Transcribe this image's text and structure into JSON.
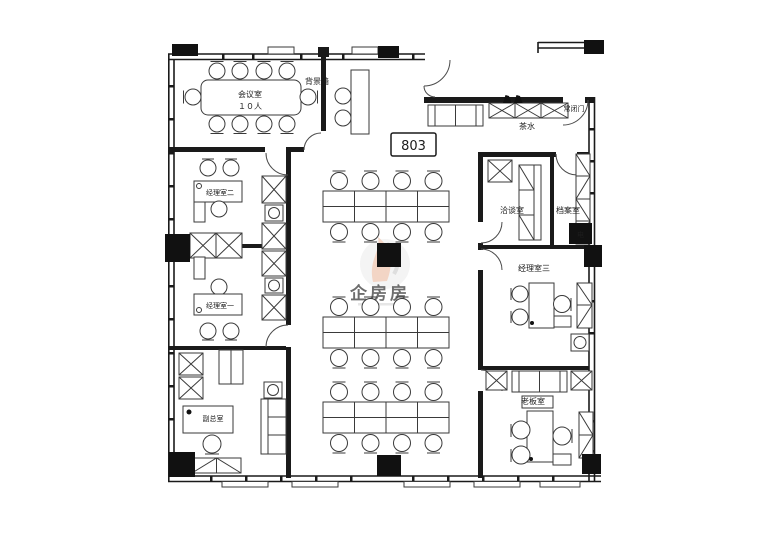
{
  "plan": {
    "unit_number": "803",
    "type": "office-floor-plan"
  },
  "labels": {
    "meeting_room": "会议室",
    "meeting_capacity": "１０人",
    "background_wall": "背景墙",
    "tea_water": "茶水",
    "normally_closed_door": "常闭门",
    "manager_room_2": "经理室二",
    "manager_room_1": "经理室一",
    "deputy_gm_room": "副总室",
    "negotiation_room": "洽谈室",
    "archive_room": "档案室",
    "manager_room_3": "经理室三",
    "boss_room": "老板室",
    "electric": "电"
  },
  "watermark": {
    "text": "企房房"
  },
  "colors": {
    "wall": "#1a1a1a",
    "furniture_line": "#3a3a3a",
    "column_fill": "#111111",
    "background": "#ffffff",
    "watermark_red": "#e2836c",
    "watermark_orange": "#efc3ac",
    "watermark_gray": "#d9d9d9"
  },
  "open_office": {
    "workstation_clusters": 3,
    "desks_per_cluster": 8,
    "chairs_per_cluster": 8
  }
}
